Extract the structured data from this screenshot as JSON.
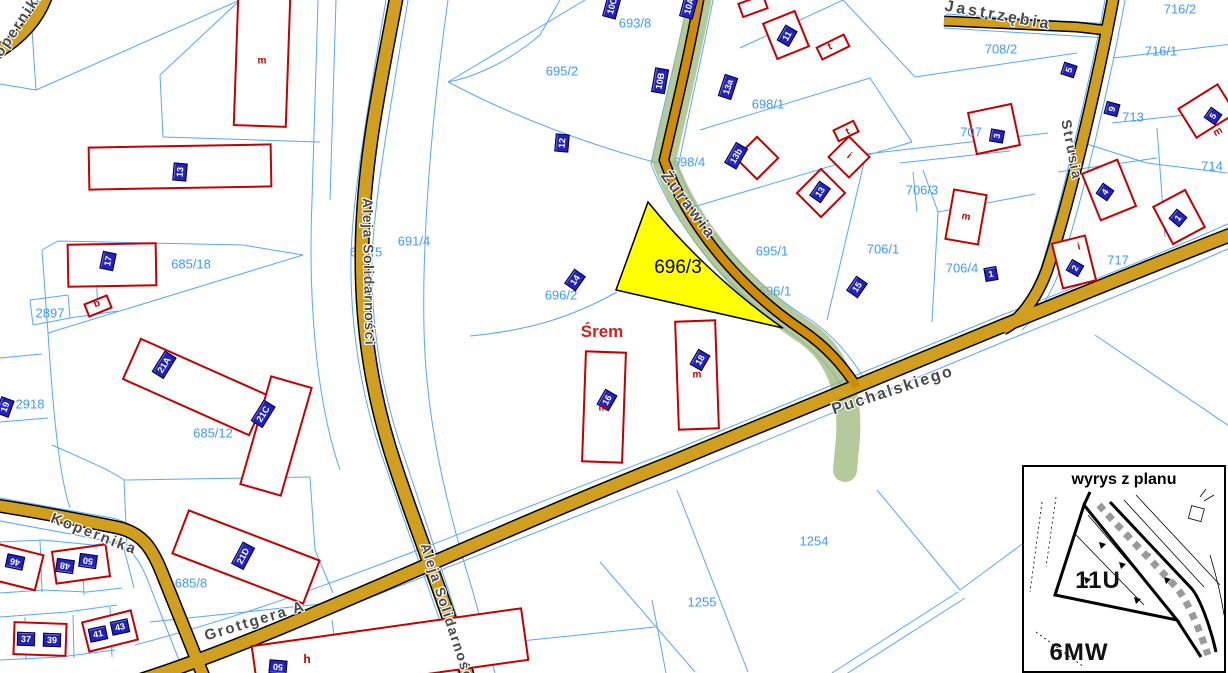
{
  "map": {
    "town": {
      "label": "Śrem",
      "color": "#cf2020"
    },
    "highlighted_parcel": {
      "id": "696/3",
      "fill": "#ffff00"
    },
    "colors": {
      "parcel_line": "#58a6ff",
      "parcel_label": "#3e9aff",
      "road_fill": "#d09f1d",
      "road_zurawia": "#cf8c00",
      "green_corridor": "#9cb87a",
      "building_outline": "#c40000",
      "house_plate_bg": "#2323bb",
      "street_label": "#4a4a4a"
    },
    "street_labels": [
      {
        "t": "Kopernika",
        "x": 16,
        "y": 28,
        "rot": -56,
        "fs": 15,
        "ls": 2
      },
      {
        "t": "Aleja Solidarności",
        "x": 369,
        "y": 272,
        "rot": 89,
        "fs": 14,
        "ls": 1.5
      },
      {
        "t": "Aleja Solidarności",
        "x": 448,
        "y": 614,
        "rot": 72,
        "fs": 14,
        "ls": 1.5
      },
      {
        "t": "Żurawia",
        "x": 688,
        "y": 206,
        "rot": 53,
        "fs": 16,
        "ls": 3
      },
      {
        "t": "Puchalskiego",
        "x": 893,
        "y": 391,
        "rot": -18,
        "fs": 16,
        "ls": 2
      },
      {
        "t": "Strusia",
        "x": 1072,
        "y": 150,
        "rot": 79,
        "fs": 14,
        "ls": 2
      },
      {
        "t": "Jastrzębia",
        "x": 998,
        "y": 16,
        "rot": 10,
        "fs": 16,
        "ls": 3
      },
      {
        "t": "Kopernika",
        "x": 94,
        "y": 534,
        "rot": 21,
        "fs": 15,
        "ls": 2
      },
      {
        "t": "Grottgera A",
        "x": 255,
        "y": 621,
        "rot": -17,
        "fs": 15,
        "ls": 2
      }
    ],
    "parcel_labels": [
      {
        "t": "693/8",
        "x": 635,
        "y": 23
      },
      {
        "t": "695/2",
        "x": 562,
        "y": 71
      },
      {
        "t": "698/1",
        "x": 768,
        "y": 104
      },
      {
        "t": "708/2",
        "x": 1001,
        "y": 49
      },
      {
        "t": "716/2",
        "x": 1180,
        "y": 9
      },
      {
        "t": "716/1",
        "x": 1161,
        "y": 51
      },
      {
        "t": "707",
        "x": 971,
        "y": 132
      },
      {
        "t": "713",
        "x": 1133,
        "y": 117
      },
      {
        "t": "714",
        "x": 1212,
        "y": 166
      },
      {
        "t": "706/3",
        "x": 922,
        "y": 190
      },
      {
        "t": "706/1",
        "x": 883,
        "y": 249
      },
      {
        "t": "706/4",
        "x": 962,
        "y": 268
      },
      {
        "t": "717",
        "x": 1118,
        "y": 260
      },
      {
        "t": "695/1",
        "x": 772,
        "y": 251
      },
      {
        "t": "691/4",
        "x": 414,
        "y": 241
      },
      {
        "t": "696/2",
        "x": 561,
        "y": 295
      },
      {
        "t": "685/18",
        "x": 191,
        "y": 264
      },
      {
        "t": "2897",
        "x": 50,
        "y": 313
      },
      {
        "t": "2918",
        "x": 30,
        "y": 404
      },
      {
        "t": "685/12",
        "x": 213,
        "y": 433
      },
      {
        "t": "685/8",
        "x": 191,
        "y": 583
      },
      {
        "t": "1254",
        "x": 814,
        "y": 541
      },
      {
        "t": "1255",
        "x": 702,
        "y": 602
      }
    ],
    "parcel_labels_under_roads": [
      {
        "t": "696/1",
        "x": 775,
        "y": 291
      },
      {
        "t": "691/5",
        "x": 366,
        "y": 252
      },
      {
        "t": "698/4",
        "x": 689,
        "y": 162
      }
    ],
    "house_number_plates": [
      {
        "t": "10C",
        "x": 612,
        "y": 6,
        "rot": -75
      },
      {
        "t": "10A",
        "x": 689,
        "y": 6,
        "rot": -75
      },
      {
        "t": "10B",
        "x": 660,
        "y": 81,
        "rot": -80
      },
      {
        "t": "12",
        "x": 562,
        "y": 143,
        "rot": -85
      },
      {
        "t": "13a",
        "x": 728,
        "y": 87,
        "rot": -72
      },
      {
        "t": "13b",
        "x": 736,
        "y": 156,
        "rot": -60
      },
      {
        "t": "11",
        "x": 787,
        "y": 36,
        "rot": -60
      },
      {
        "t": "5",
        "x": 1069,
        "y": 70,
        "rot": -72
      },
      {
        "t": "9",
        "x": 1112,
        "y": 109,
        "rot": -75
      },
      {
        "t": "3",
        "x": 997,
        "y": 136,
        "rot": -80
      },
      {
        "t": "5",
        "x": 1213,
        "y": 116,
        "rot": -55
      },
      {
        "t": "13",
        "x": 820,
        "y": 192,
        "rot": -55
      },
      {
        "t": "15",
        "x": 857,
        "y": 287,
        "rot": -55
      },
      {
        "t": "4",
        "x": 1105,
        "y": 192,
        "rot": -55
      },
      {
        "t": "1",
        "x": 1178,
        "y": 218,
        "rot": -50
      },
      {
        "t": "2",
        "x": 1075,
        "y": 268,
        "rot": -60
      },
      {
        "t": "1",
        "x": 991,
        "y": 274,
        "rot": -10
      },
      {
        "t": "14",
        "x": 575,
        "y": 280,
        "rot": -55
      },
      {
        "t": "16",
        "x": 607,
        "y": 400,
        "rot": -60
      },
      {
        "t": "18",
        "x": 700,
        "y": 360,
        "rot": -60
      },
      {
        "t": "13",
        "x": 180,
        "y": 172,
        "rot": -85
      },
      {
        "t": "17",
        "x": 108,
        "y": 261,
        "rot": -78
      },
      {
        "t": "19",
        "x": 5,
        "y": 407,
        "rot": -70
      },
      {
        "t": "21A",
        "x": 164,
        "y": 365,
        "rot": -58
      },
      {
        "t": "21C",
        "x": 263,
        "y": 414,
        "rot": -58
      },
      {
        "t": "21D",
        "x": 243,
        "y": 556,
        "rot": -62
      },
      {
        "t": "46",
        "x": 15,
        "y": 562,
        "rot": 192
      },
      {
        "t": "48",
        "x": 65,
        "y": 566,
        "rot": 188
      },
      {
        "t": "50",
        "x": 88,
        "y": 561,
        "rot": 188
      },
      {
        "t": "37",
        "x": 26,
        "y": 639,
        "rot": 2
      },
      {
        "t": "39",
        "x": 52,
        "y": 640,
        "rot": 2
      },
      {
        "t": "41",
        "x": 98,
        "y": 634,
        "rot": -12
      },
      {
        "t": "43",
        "x": 120,
        "y": 627,
        "rot": -12
      },
      {
        "t": "50",
        "x": 278,
        "y": 667,
        "rot": 185
      }
    ],
    "building_letters": [
      {
        "t": "m",
        "x": 262,
        "y": 61,
        "rot": 0
      },
      {
        "t": "m",
        "x": 966,
        "y": 217,
        "rot": 12
      },
      {
        "t": "m",
        "x": 1218,
        "y": 132,
        "rot": -30
      },
      {
        "t": "m",
        "x": 697,
        "y": 375,
        "rot": 0
      },
      {
        "t": "m",
        "x": 603,
        "y": 408,
        "rot": 0
      },
      {
        "t": "t",
        "x": 830,
        "y": 47,
        "rot": -25
      },
      {
        "t": "t",
        "x": 848,
        "y": 132,
        "rot": -25
      },
      {
        "t": "i",
        "x": 849,
        "y": 156,
        "rot": 40
      },
      {
        "t": "i",
        "x": 1079,
        "y": 247,
        "rot": -15
      },
      {
        "t": "h",
        "x": 307,
        "y": 659,
        "rot": 0
      },
      {
        "t": "b",
        "x": 97,
        "y": 304,
        "rot": -20
      }
    ],
    "inset": {
      "title": "wyrys z planu",
      "zone_upper": "11U",
      "zone_lower": "6MW"
    }
  }
}
